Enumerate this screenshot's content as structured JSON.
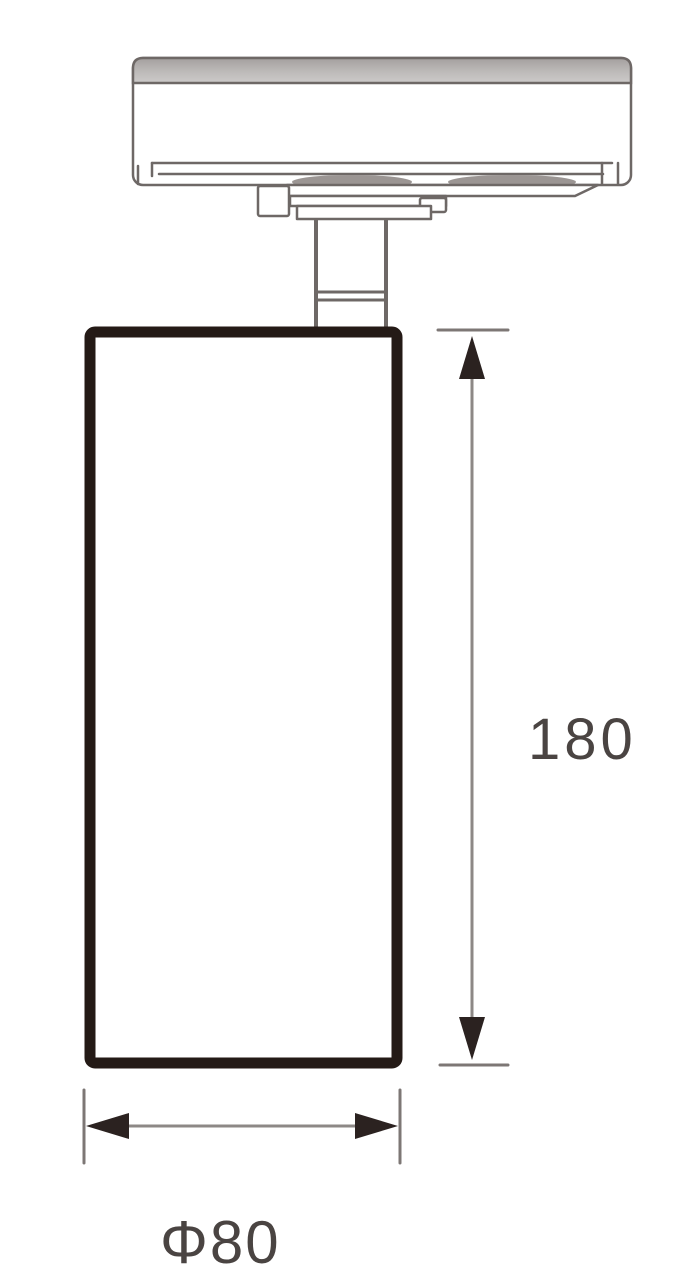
{
  "page": {
    "background": "#ffffff",
    "type": "technical dimension drawing"
  },
  "drawing": {
    "subject": "track-mounted cylindrical spotlight, side elevation",
    "labels": {
      "height_dim": "180",
      "diameter_dim": "Φ80"
    },
    "values": {
      "height": 180,
      "diameter": 80,
      "diameter_symbol": "Φ"
    },
    "colors": {
      "outline_gray": "#6e6866",
      "body_outline_dark": "#241a16",
      "dim_line_gray": "#8d8886",
      "arrow_dark": "#2b2220",
      "dim_text": "#4a4442",
      "band_gradient_top": "#a49f9e",
      "band_gradient_bottom": "#cccac9",
      "shade_gray": "#9b9593",
      "background": "#ffffff"
    },
    "parts": [
      "track-rail",
      "track-adapter",
      "stem",
      "lamp-body",
      "height-dimension",
      "diameter-dimension"
    ]
  }
}
